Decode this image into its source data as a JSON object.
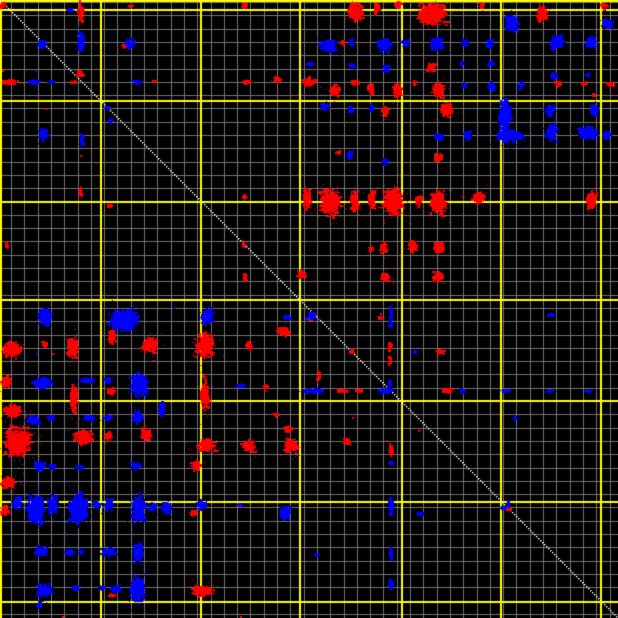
{
  "chart_data": {
    "type": "scatter",
    "title": "",
    "xlabel": "",
    "ylabel": "",
    "canvas": {
      "width": 618,
      "height": 618,
      "background": "#000000"
    },
    "grid": {
      "minor_step": 13.3,
      "minor_offset_x": 11,
      "minor_offset_y": 2,
      "minor_color": "#757575",
      "major_color": "#ffff00",
      "major_width": 2,
      "major_x": [
        0,
        100,
        200,
        299,
        401,
        500,
        600
      ],
      "major_y": [
        0,
        9,
        100,
        201,
        299,
        400,
        501,
        601
      ]
    },
    "diagonal": {
      "color": "#ffffff",
      "from": [
        0,
        0
      ],
      "to": [
        618,
        618
      ]
    },
    "palette": {
      "forward_match": "#ff0000",
      "reverse_match": "#0000ff"
    },
    "clusters": [
      [
        "r",
        3,
        5,
        8,
        10
      ],
      [
        "r",
        81,
        12,
        6,
        26
      ],
      [
        "b",
        71,
        10,
        5,
        4
      ],
      [
        "r",
        131,
        6,
        4,
        3
      ],
      [
        "r",
        245,
        6,
        6,
        5
      ],
      [
        "b",
        81,
        42,
        9,
        26
      ],
      [
        "b",
        42,
        44,
        9,
        10
      ],
      [
        "b",
        130,
        44,
        13,
        13
      ],
      [
        "r",
        124,
        46,
        5,
        4
      ],
      [
        "r",
        80,
        74,
        7,
        9
      ],
      [
        "r",
        10,
        82,
        22,
        6
      ],
      [
        "b",
        35,
        82,
        15,
        5
      ],
      [
        "b",
        52,
        82,
        7,
        4
      ],
      [
        "r",
        73,
        82,
        8,
        4
      ],
      [
        "b",
        137,
        82,
        12,
        5
      ],
      [
        "r",
        155,
        81,
        4,
        3
      ],
      [
        "r",
        247,
        82,
        12,
        5
      ],
      [
        "r",
        277,
        80,
        11,
        8
      ],
      [
        "b",
        108,
        108,
        5,
        4
      ],
      [
        "b",
        111,
        121,
        4,
        7
      ],
      [
        "b",
        43,
        134,
        10,
        14
      ],
      [
        "b",
        82,
        140,
        6,
        17
      ],
      [
        "r",
        80,
        192,
        4,
        12
      ],
      [
        "r",
        245,
        197,
        5,
        8
      ],
      [
        "r",
        110,
        206,
        6,
        4
      ],
      [
        "r",
        7,
        245,
        4,
        8
      ],
      [
        "r",
        244,
        244,
        5,
        10
      ],
      [
        "r",
        245,
        277,
        5,
        10
      ],
      [
        "r",
        356,
        12,
        18,
        24
      ],
      [
        "r",
        377,
        9,
        6,
        13
      ],
      [
        "r",
        398,
        5,
        8,
        8
      ],
      [
        "r",
        432,
        13,
        34,
        27
      ],
      [
        "r",
        482,
        6,
        6,
        9
      ],
      [
        "b",
        512,
        23,
        18,
        20
      ],
      [
        "r",
        542,
        14,
        12,
        20
      ],
      [
        "r",
        604,
        6,
        10,
        7
      ],
      [
        "b",
        608,
        24,
        13,
        11
      ],
      [
        "r",
        343,
        43,
        4,
        6
      ],
      [
        "b",
        328,
        46,
        22,
        16
      ],
      [
        "b",
        352,
        43,
        6,
        10
      ],
      [
        "b",
        384,
        45,
        16,
        18
      ],
      [
        "b",
        406,
        43,
        8,
        9
      ],
      [
        "b",
        437,
        44,
        15,
        16
      ],
      [
        "b",
        465,
        43,
        8,
        10
      ],
      [
        "b",
        490,
        44,
        9,
        11
      ],
      [
        "b",
        557,
        42,
        16,
        18
      ],
      [
        "b",
        591,
        42,
        13,
        14
      ],
      [
        "b",
        310,
        64,
        7,
        7
      ],
      [
        "b",
        352,
        66,
        6,
        9
      ],
      [
        "b",
        386,
        69,
        7,
        11
      ],
      [
        "r",
        431,
        67,
        11,
        12
      ],
      [
        "b",
        462,
        64,
        4,
        6
      ],
      [
        "b",
        491,
        64,
        6,
        8
      ],
      [
        "b",
        554,
        76,
        9,
        9
      ],
      [
        "b",
        588,
        75,
        5,
        5
      ],
      [
        "b",
        521,
        85,
        7,
        9
      ],
      [
        "r",
        309,
        82,
        16,
        9
      ],
      [
        "r",
        335,
        90,
        11,
        15
      ],
      [
        "r",
        355,
        83,
        9,
        6
      ],
      [
        "r",
        371,
        89,
        8,
        15
      ],
      [
        "r",
        398,
        91,
        11,
        17
      ],
      [
        "r",
        415,
        83,
        6,
        5
      ],
      [
        "r",
        438,
        90,
        15,
        18
      ],
      [
        "b",
        464,
        85,
        6,
        7
      ],
      [
        "b",
        492,
        87,
        7,
        11
      ],
      [
        "r",
        558,
        84,
        10,
        6
      ],
      [
        "r",
        585,
        84,
        9,
        5
      ],
      [
        "r",
        610,
        84,
        9,
        5
      ],
      [
        "b",
        325,
        106,
        9,
        10
      ],
      [
        "b",
        351,
        109,
        7,
        11
      ],
      [
        "b",
        372,
        108,
        6,
        10
      ],
      [
        "r",
        385,
        111,
        9,
        12
      ],
      [
        "r",
        447,
        110,
        15,
        17
      ],
      [
        "b",
        505,
        115,
        16,
        38
      ],
      [
        "b",
        550,
        110,
        10,
        15
      ],
      [
        "b",
        594,
        110,
        10,
        14
      ],
      [
        "r",
        594,
        95,
        4,
        4
      ],
      [
        "b",
        439,
        137,
        12,
        9
      ],
      [
        "b",
        468,
        136,
        9,
        12
      ],
      [
        "b",
        509,
        136,
        30,
        16
      ],
      [
        "b",
        520,
        136,
        8,
        7
      ],
      [
        "b",
        552,
        133,
        15,
        18
      ],
      [
        "b",
        588,
        133,
        24,
        16
      ],
      [
        "b",
        607,
        135,
        10,
        10
      ],
      [
        "r",
        339,
        153,
        5,
        6
      ],
      [
        "b",
        350,
        156,
        7,
        11
      ],
      [
        "b",
        385,
        162,
        5,
        8
      ],
      [
        "r",
        438,
        158,
        10,
        12
      ],
      [
        "r",
        307,
        199,
        9,
        24
      ],
      [
        "r",
        330,
        202,
        26,
        32
      ],
      [
        "r",
        355,
        200,
        10,
        26
      ],
      [
        "r",
        372,
        200,
        8,
        22
      ],
      [
        "r",
        393,
        201,
        24,
        34
      ],
      [
        "r",
        419,
        200,
        8,
        14
      ],
      [
        "r",
        438,
        203,
        20,
        30
      ],
      [
        "r",
        479,
        198,
        15,
        13
      ],
      [
        "r",
        592,
        201,
        13,
        22
      ],
      [
        "r",
        371,
        249,
        5,
        8
      ],
      [
        "r",
        384,
        247,
        9,
        13
      ],
      [
        "r",
        413,
        247,
        11,
        13
      ],
      [
        "r",
        439,
        248,
        13,
        15
      ],
      [
        "r",
        302,
        275,
        11,
        13
      ],
      [
        "r",
        386,
        277,
        12,
        11
      ],
      [
        "r",
        438,
        277,
        14,
        12
      ],
      [
        "b",
        312,
        314,
        8,
        8
      ],
      [
        "r",
        310,
        319,
        6,
        4
      ],
      [
        "b",
        391,
        316,
        4,
        28
      ],
      [
        "r",
        380,
        317,
        5,
        6
      ],
      [
        "b",
        288,
        318,
        12,
        5
      ],
      [
        "b",
        310,
        318,
        14,
        4
      ],
      [
        "r",
        390,
        346,
        4,
        13
      ],
      [
        "r",
        390,
        361,
        4,
        10
      ],
      [
        "r",
        352,
        351,
        6,
        5
      ],
      [
        "b",
        415,
        352,
        4,
        4
      ],
      [
        "r",
        440,
        352,
        11,
        6
      ],
      [
        "r",
        319,
        377,
        4,
        14
      ],
      [
        "b",
        390,
        384,
        4,
        13
      ],
      [
        "b",
        551,
        315,
        7,
        4
      ],
      [
        "b",
        314,
        391,
        30,
        5
      ],
      [
        "r",
        343,
        391,
        13,
        5
      ],
      [
        "r",
        360,
        391,
        8,
        4
      ],
      [
        "b",
        386,
        391,
        18,
        6
      ],
      [
        "r",
        447,
        391,
        14,
        5
      ],
      [
        "b",
        463,
        391,
        4,
        4
      ],
      [
        "b",
        505,
        391,
        12,
        4
      ],
      [
        "b",
        550,
        391,
        9,
        4
      ],
      [
        "b",
        588,
        391,
        8,
        4
      ],
      [
        "r",
        347,
        442,
        8,
        10
      ],
      [
        "r",
        391,
        450,
        5,
        15
      ],
      [
        "b",
        391,
        463,
        5,
        4
      ],
      [
        "b",
        515,
        418,
        5,
        4
      ],
      [
        "b",
        391,
        505,
        6,
        22
      ],
      [
        "b",
        420,
        514,
        7,
        5
      ],
      [
        "b",
        317,
        555,
        3,
        3
      ],
      [
        "b",
        391,
        555,
        5,
        15
      ],
      [
        "b",
        391,
        584,
        6,
        13
      ],
      [
        "b",
        505,
        508,
        11,
        4
      ],
      [
        "b",
        508,
        503,
        3,
        7
      ],
      [
        "r",
        509,
        510,
        3,
        3
      ],
      [
        "b",
        45,
        318,
        16,
        22
      ],
      [
        "b",
        124,
        320,
        34,
        28
      ],
      [
        "b",
        207,
        316,
        16,
        18
      ],
      [
        "r",
        12,
        349,
        24,
        18
      ],
      [
        "r",
        45,
        345,
        7,
        10
      ],
      [
        "r",
        72,
        348,
        13,
        26
      ],
      [
        "r",
        112,
        337,
        10,
        16
      ],
      [
        "r",
        150,
        345,
        19,
        20
      ],
      [
        "r",
        205,
        346,
        22,
        32
      ],
      [
        "r",
        249,
        345,
        8,
        11
      ],
      [
        "r",
        283,
        331,
        15,
        12
      ],
      [
        "r",
        6,
        382,
        12,
        14
      ],
      [
        "b",
        42,
        383,
        22,
        14
      ],
      [
        "r",
        74,
        399,
        9,
        36
      ],
      [
        "b",
        88,
        380,
        18,
        6
      ],
      [
        "b",
        108,
        380,
        10,
        7
      ],
      [
        "b",
        140,
        385,
        21,
        28
      ],
      [
        "r",
        111,
        391,
        9,
        9
      ],
      [
        "r",
        205,
        395,
        10,
        40
      ],
      [
        "b",
        240,
        386,
        11,
        6
      ],
      [
        "r",
        266,
        388,
        5,
        7
      ],
      [
        "r",
        276,
        415,
        4,
        5
      ],
      [
        "r",
        13,
        411,
        22,
        14
      ],
      [
        "b",
        33,
        420,
        16,
        12
      ],
      [
        "b",
        52,
        418,
        8,
        8
      ],
      [
        "b",
        90,
        418,
        18,
        7
      ],
      [
        "b",
        108,
        418,
        13,
        6
      ],
      [
        "b",
        138,
        417,
        12,
        16
      ],
      [
        "b",
        162,
        409,
        8,
        16
      ],
      [
        "r",
        18,
        442,
        32,
        38
      ],
      [
        "r",
        84,
        437,
        26,
        18
      ],
      [
        "r",
        108,
        436,
        9,
        11
      ],
      [
        "r",
        146,
        434,
        13,
        15
      ],
      [
        "r",
        207,
        445,
        22,
        16
      ],
      [
        "r",
        249,
        447,
        15,
        14
      ],
      [
        "r",
        291,
        446,
        17,
        18
      ],
      [
        "r",
        288,
        429,
        10,
        8
      ],
      [
        "b",
        40,
        466,
        15,
        12
      ],
      [
        "b",
        52,
        467,
        8,
        8
      ],
      [
        "b",
        79,
        467,
        13,
        5
      ],
      [
        "b",
        136,
        466,
        12,
        10
      ],
      [
        "r",
        196,
        466,
        10,
        13
      ],
      [
        "r",
        8,
        483,
        18,
        14
      ],
      [
        "r",
        5,
        511,
        10,
        12
      ],
      [
        "b",
        17,
        503,
        12,
        18
      ],
      [
        "b",
        36,
        509,
        22,
        36
      ],
      [
        "b",
        53,
        505,
        12,
        22
      ],
      [
        "b",
        78,
        509,
        24,
        40
      ],
      [
        "b",
        97,
        505,
        8,
        12
      ],
      [
        "b",
        109,
        505,
        10,
        15
      ],
      [
        "b",
        139,
        509,
        18,
        32
      ],
      [
        "b",
        153,
        507,
        10,
        12
      ],
      [
        "b",
        166,
        508,
        13,
        14
      ],
      [
        "b",
        202,
        505,
        13,
        11
      ],
      [
        "r",
        194,
        513,
        7,
        8
      ],
      [
        "b",
        240,
        505,
        4,
        4
      ],
      [
        "b",
        285,
        513,
        13,
        18
      ],
      [
        "b",
        41,
        552,
        16,
        14
      ],
      [
        "b",
        70,
        552,
        10,
        9
      ],
      [
        "b",
        81,
        552,
        6,
        6
      ],
      [
        "b",
        109,
        552,
        19,
        9
      ],
      [
        "b",
        138,
        553,
        11,
        26
      ],
      [
        "b",
        44,
        590,
        19,
        15
      ],
      [
        "b",
        76,
        588,
        6,
        7
      ],
      [
        "b",
        102,
        588,
        8,
        6
      ],
      [
        "b",
        116,
        589,
        15,
        9
      ],
      [
        "b",
        137,
        590,
        18,
        32
      ],
      [
        "r",
        112,
        596,
        7,
        5
      ],
      [
        "r",
        202,
        591,
        26,
        13
      ],
      [
        "b",
        39,
        605,
        7,
        9
      ]
    ],
    "speckles": [
      [
        "r",
        45,
        108
      ],
      [
        "r",
        80,
        155
      ],
      [
        "r",
        2,
        70
      ],
      [
        "b",
        35,
        70
      ],
      [
        "r",
        352,
        417
      ],
      [
        "r",
        418,
        430
      ],
      [
        "r",
        462,
        196
      ],
      [
        "r",
        62,
        616
      ],
      [
        "r",
        240,
        616
      ],
      [
        "b",
        173,
        307
      ],
      [
        "b",
        210,
        307
      ],
      [
        "r",
        52,
        353
      ],
      [
        "b",
        36,
        353
      ]
    ]
  }
}
